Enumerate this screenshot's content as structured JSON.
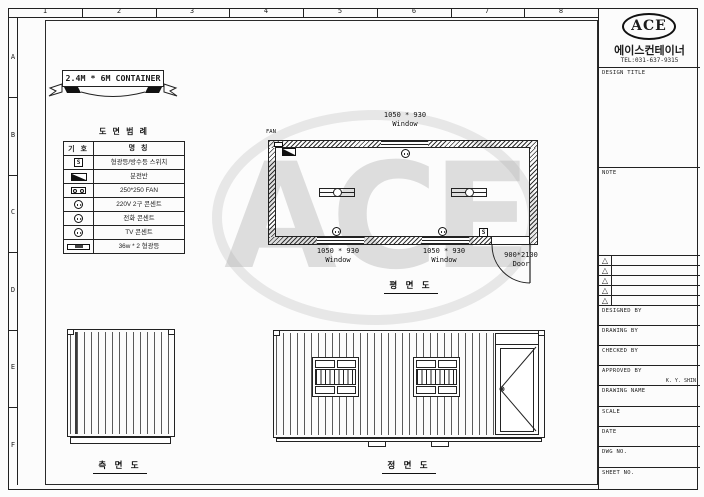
{
  "colors": {
    "line": "#1c1c1c",
    "paper": "#fcfcfc",
    "watermark": "#bdbdbd",
    "hatch": "#333333"
  },
  "sheet_border": {
    "columns": [
      "1",
      "2",
      "3",
      "4",
      "5",
      "6",
      "7",
      "8"
    ],
    "rows": [
      "A",
      "B",
      "C",
      "D",
      "E",
      "F"
    ]
  },
  "banner": {
    "title": "2.4M * 6M CONTAINER"
  },
  "watermark": {
    "text": "ACE"
  },
  "legend": {
    "title": "도 면 범 례",
    "header": {
      "symbol": "기 호",
      "name": "명    칭"
    },
    "rows": [
      {
        "symbol": "S",
        "icon": "switch-icon",
        "name": "형광등/방수등 스위치"
      },
      {
        "symbol": "",
        "icon": "panel-icon",
        "name": "분전반"
      },
      {
        "symbol": "",
        "icon": "fan-icon",
        "name": "250*250 FAN"
      },
      {
        "symbol": "",
        "icon": "outlet-icon",
        "name": "220V 2구 콘센트"
      },
      {
        "symbol": "",
        "icon": "tel-outlet-icon",
        "name": "전화 콘센트"
      },
      {
        "symbol": "",
        "icon": "tv-outlet-icon",
        "name": "TV 콘센트"
      },
      {
        "symbol": "",
        "icon": "lamp-icon",
        "name": "36w * 2 형광등"
      }
    ]
  },
  "plan_view": {
    "label": "평 면 도",
    "fan_label": "FAN",
    "switch_symbol": "S",
    "windows": [
      {
        "size": "1050 * 930",
        "type": "Window"
      },
      {
        "size": "1050 * 930",
        "type": "Window"
      },
      {
        "size": "1050 * 930",
        "type": "Window"
      }
    ],
    "door": {
      "size": "900*2100",
      "type": "Door"
    }
  },
  "side_view": {
    "label": "측 면 도"
  },
  "front_view": {
    "label": "정 면 도"
  },
  "title_block": {
    "logo": "ACE",
    "company": "에이스컨테이너",
    "tel": "TEL:031-637-9315",
    "design_title_label": "DESIGN TITLE",
    "note_label": "NOTE",
    "revision_symbol": "△",
    "fields": [
      {
        "label": "DESIGNED BY",
        "value": ""
      },
      {
        "label": "DRAWING BY",
        "value": ""
      },
      {
        "label": "CHECKED BY",
        "value": ""
      },
      {
        "label": "APPROVED BY",
        "value": "K. Y. SHIN"
      },
      {
        "label": "DRAWING NAME",
        "value": ""
      },
      {
        "label": "SCALE",
        "value": ""
      },
      {
        "label": "DATE",
        "value": ""
      },
      {
        "label": "DWG NO.",
        "value": ""
      },
      {
        "label": "SHEET NO.",
        "value": ""
      }
    ]
  }
}
